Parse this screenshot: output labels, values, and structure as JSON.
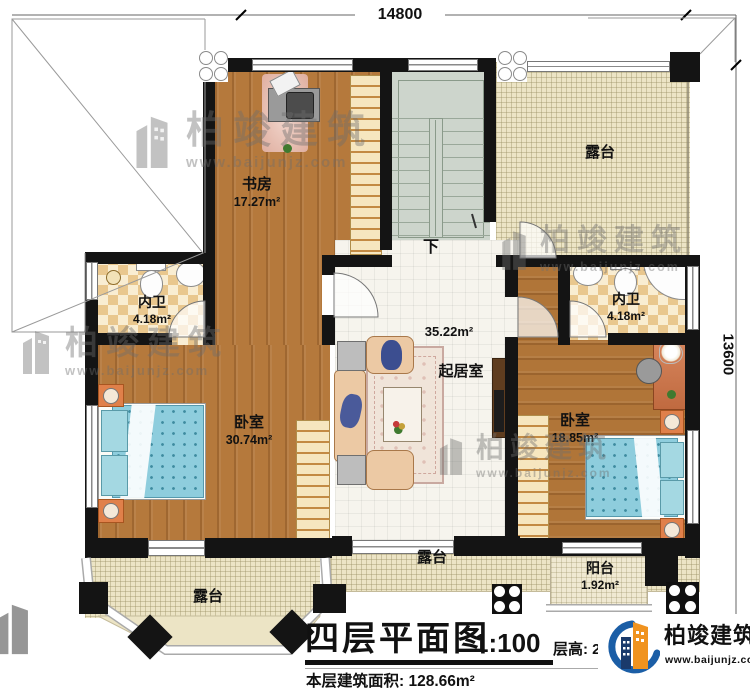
{
  "dimensions": {
    "width_label": "14800",
    "height_label": "13600"
  },
  "rooms": {
    "study": {
      "name": "书房",
      "area": "17.27m²"
    },
    "terrace_top": {
      "name": "露台"
    },
    "bath_left": {
      "name": "内卫",
      "area": "4.18m²"
    },
    "bath_right": {
      "name": "内卫",
      "area": "4.18m²"
    },
    "living": {
      "name": "起居室",
      "area": "35.22m²"
    },
    "bedroom_left": {
      "name": "卧室",
      "area": "30.74m²"
    },
    "bedroom_right": {
      "name": "卧室",
      "area": "18.85m²"
    },
    "terrace_mid": {
      "name": "露台"
    },
    "terrace_bottom_left": {
      "name": "露台"
    },
    "balcony": {
      "name": "阳台",
      "area": "1.92m²"
    },
    "stairs": {
      "down_label": "下"
    }
  },
  "title_block": {
    "title": "四层平面图",
    "scale": "1:100",
    "area_line": "本层建筑面积: 128.66m²",
    "floor_height": "层高: 2"
  },
  "logo": {
    "name": "柏竣建筑",
    "url": "www.baijunjz.com"
  },
  "watermark": {
    "name": "柏竣建筑",
    "url": "www.baijunjz.com"
  },
  "palette": {
    "wood": "#b5793c",
    "bathroom_tile": "#eac88f",
    "terrace": "#ece4c5",
    "stairs": "#cdd5cc",
    "bed": "#8ecddd",
    "nightstand": "#e0804a",
    "logo_blue": "#1b5ea6",
    "logo_orange": "#f0931f"
  }
}
